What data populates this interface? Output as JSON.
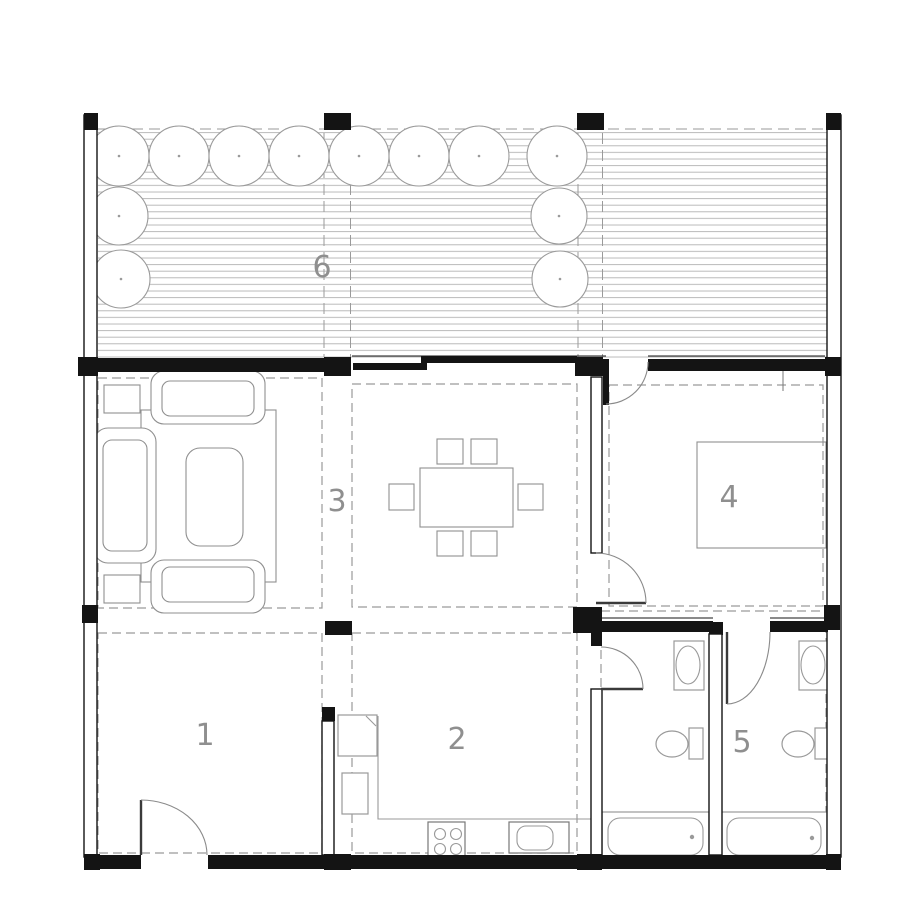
{
  "drawing": {
    "type": "architectural-floor-plan",
    "room_labels": [
      {
        "id": "room-1",
        "number": "1"
      },
      {
        "id": "room-2",
        "number": "2"
      },
      {
        "id": "room-3",
        "number": "3"
      },
      {
        "id": "room-4",
        "number": "4"
      },
      {
        "id": "room-5",
        "number": "5"
      },
      {
        "id": "room-6",
        "number": "6"
      }
    ],
    "colors": {
      "background": "#ffffff",
      "wall": "#141414",
      "furniture_line": "#8f8f8f",
      "fixture_line": "#999999",
      "dashed_line": "#9a9a9a",
      "deck_line": "#b3b3b3",
      "label_text": "#8f8f8f"
    }
  }
}
